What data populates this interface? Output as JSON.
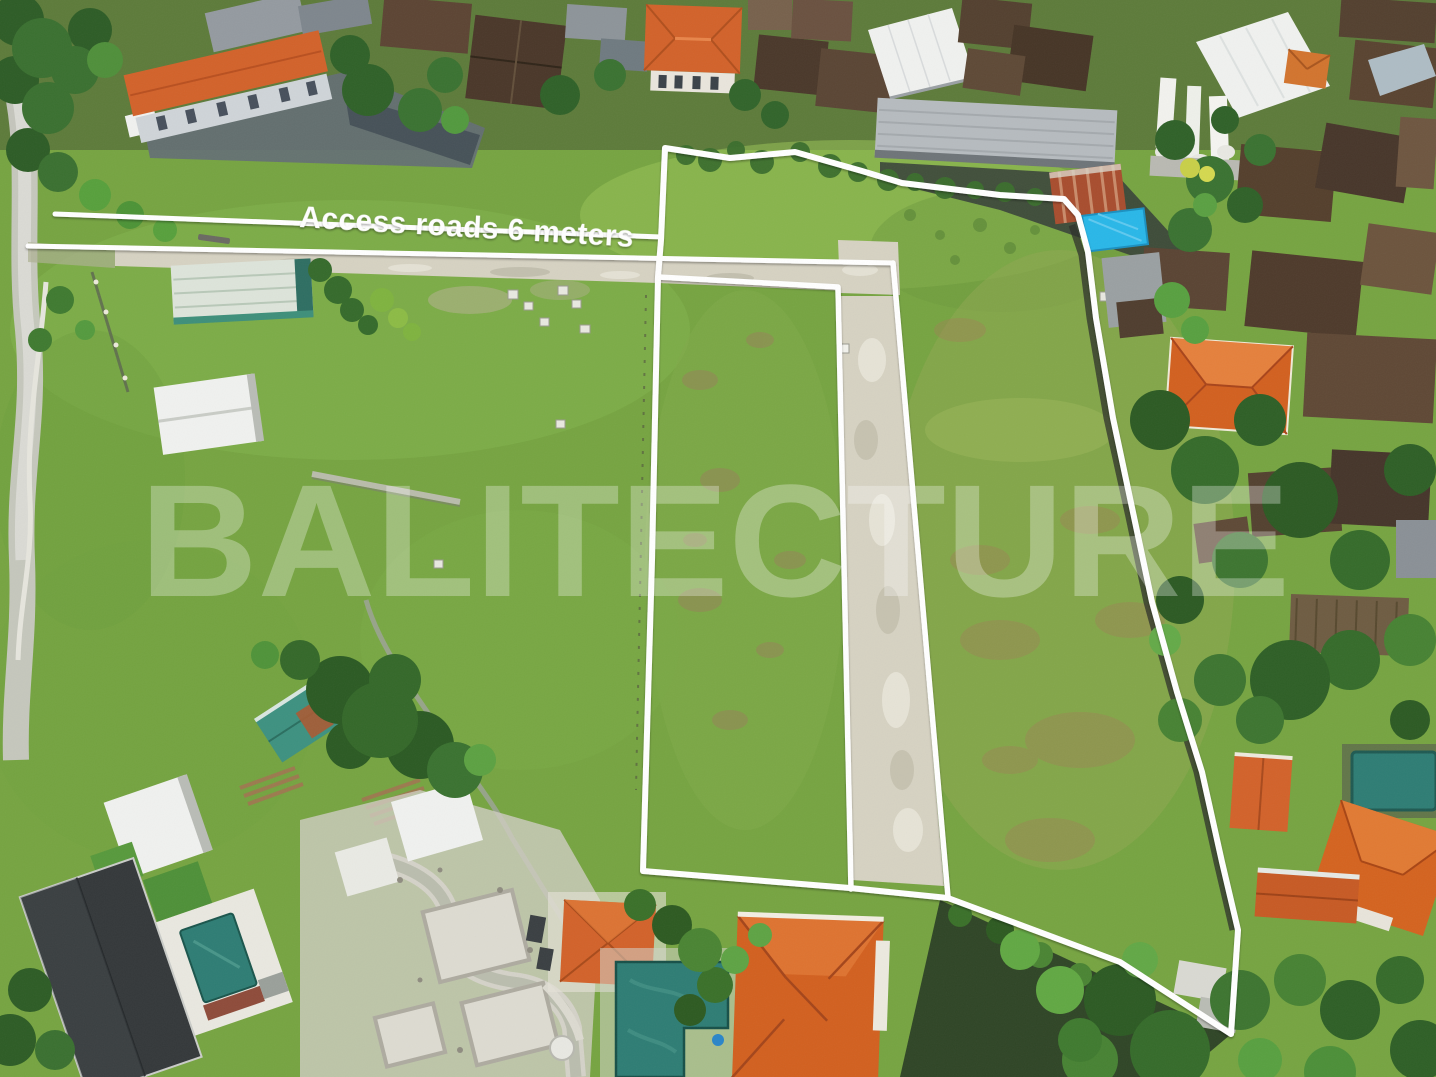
{
  "scene": {
    "description": "Aerial drone photograph of green land plots outlined with white boundary lines, surrounded by village houses with orange and brown tiled roofs, pools and tropical trees"
  },
  "annotations": {
    "access_road_label": "Access roads 6 meters",
    "watermark": "BALITECTURE"
  },
  "colors": {
    "boundary_line": "#ffffff",
    "label_text": "#ffffff",
    "watermark": "#ffffff",
    "grass": "#76a441",
    "grass_dry": "#9aa85c",
    "road_gravel": "#d6d2c2",
    "roof_orange": "#d2622a",
    "roof_brown": "#4e3a2b",
    "roof_white": "#f0f1ef",
    "roof_gray": "#b6bbbf",
    "pool_teal": "#2e7d74",
    "tarp_blue": "#29b7e8",
    "tree_green": "#33632a"
  }
}
